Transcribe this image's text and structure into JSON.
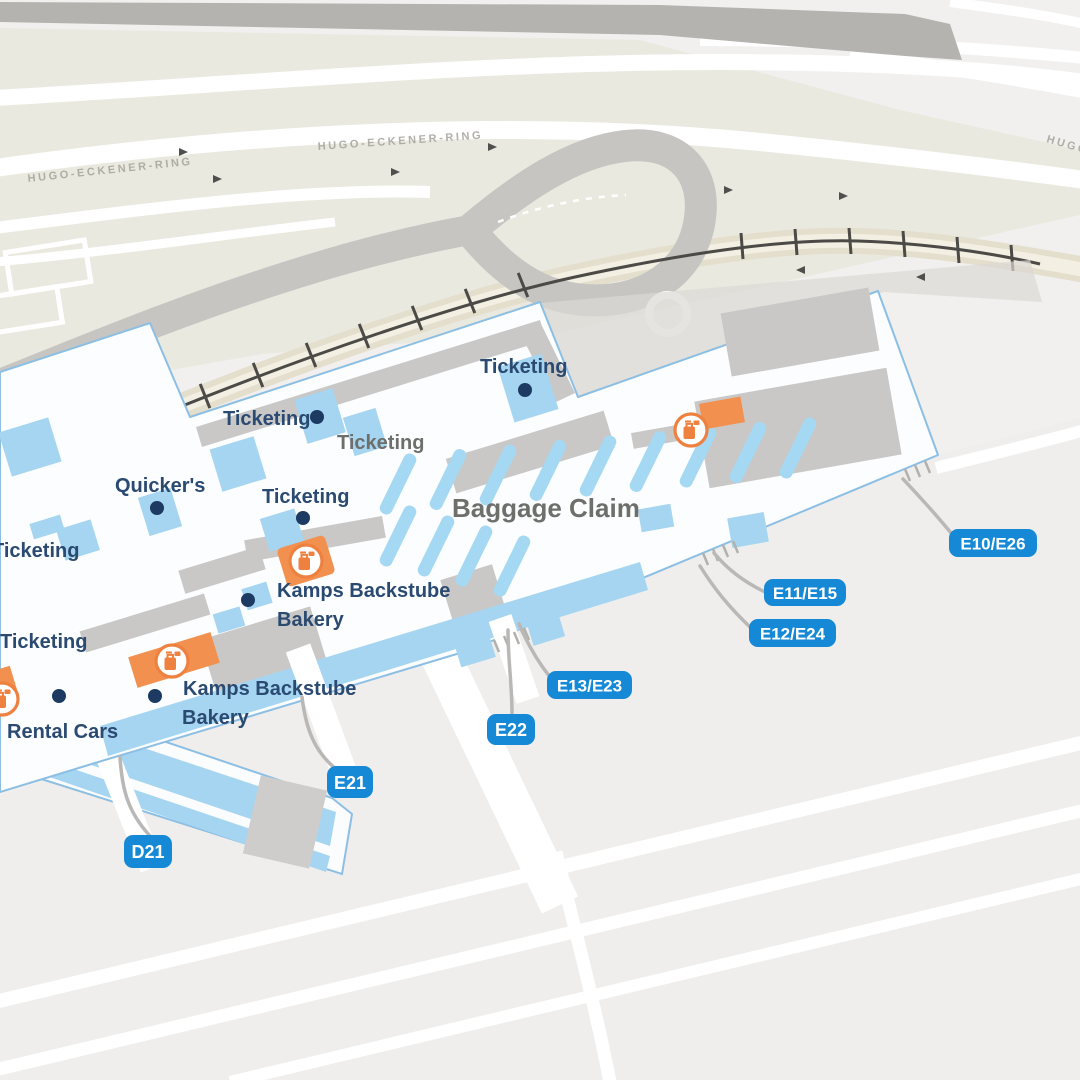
{
  "map": {
    "road_labels": [
      {
        "id": "hugo-eckener-ring-left",
        "label": "HUGO-ECKENER-RING"
      },
      {
        "id": "hugo-eckener-ring-mid",
        "label": "HUGO-ECKENER-RING"
      },
      {
        "id": "hugo-eckener-ring-right",
        "label": "HUGO-ECKENER-RING"
      }
    ],
    "area_labels": [
      {
        "id": "ticketing-area",
        "label": "Ticketing"
      },
      {
        "id": "baggage-claim-area",
        "label": "Baggage Claim"
      }
    ],
    "poi_labels": [
      {
        "id": "ticketing-upper-right",
        "label": "Ticketing"
      },
      {
        "id": "ticketing-upper-left",
        "label": "Ticketing"
      },
      {
        "id": "quickers",
        "label": "Quicker's"
      },
      {
        "id": "ticketing-mid-left",
        "label": "Ticketing"
      },
      {
        "id": "ticketing-left-edge",
        "label": "Ticketing"
      },
      {
        "id": "ticketing-lower-left",
        "label": "Ticketing"
      },
      {
        "id": "kamps-bakery-1",
        "label": "Kamps Backstube",
        "label2": "Bakery"
      },
      {
        "id": "kamps-bakery-2",
        "label": "Kamps Backstube",
        "label2": "Bakery"
      },
      {
        "id": "rental-cars",
        "label": "Rental Cars"
      }
    ],
    "gates": [
      {
        "id": "gate-d21",
        "label": "D21"
      },
      {
        "id": "gate-e21",
        "label": "E21"
      },
      {
        "id": "gate-e22",
        "label": "E22"
      },
      {
        "id": "gate-e13-e23",
        "label": "E13/E23"
      },
      {
        "id": "gate-e12-e24",
        "label": "E12/E24"
      },
      {
        "id": "gate-e11-e15",
        "label": "E11/E15"
      },
      {
        "id": "gate-e10-e26",
        "label": "E10/E26"
      }
    ],
    "icons": {
      "amenity": "luggage-icon",
      "count": 4
    },
    "colors": {
      "badge_blue": "#1689d6",
      "navy_label": "#2b4a71",
      "gray_label": "#6e6e6b",
      "orange": "#ee8040",
      "tile_blue": "#a5d5f0",
      "building_border": "#8cbfe3",
      "road_gray": "#c7c5c2",
      "rail_dark": "#4b4a47",
      "beige": "#eae9e0"
    }
  }
}
